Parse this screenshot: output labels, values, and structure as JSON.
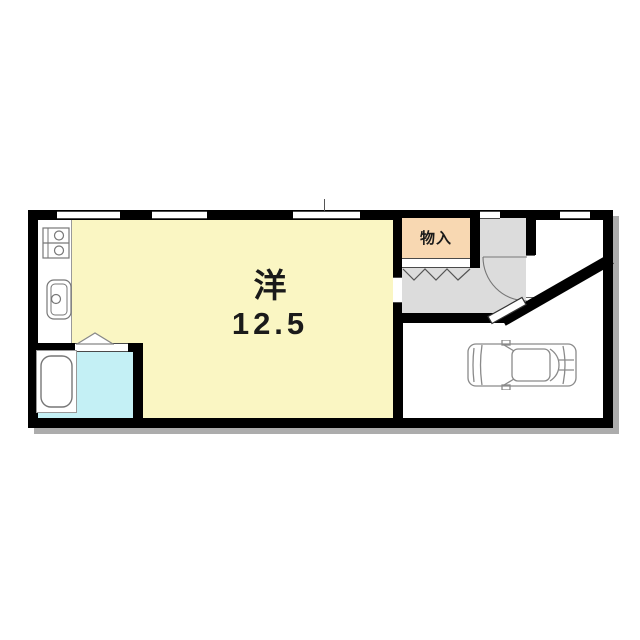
{
  "plan": {
    "type": "japanese-apartment-floor-plan",
    "main_room": {
      "name": "洋",
      "size": "12.5"
    },
    "storage": {
      "label": "物入"
    },
    "colors": {
      "wall": "#000000",
      "shadow": "#acacac",
      "main_room_fill": "#faf6c3",
      "storage_fill": "#f8d8b2",
      "bathroom_fill": "#c4f0f5",
      "entry_hall_fill": "#dcdcdc",
      "parking_fill": "#ffffff",
      "counter_fill": "#ffffff",
      "outline_gray": "#777777",
      "text": "#1a1a1a"
    },
    "icons": [
      "stove-icon",
      "sink-icon",
      "bathtub-icon",
      "bath-folding-door-icon",
      "zigzag-closet-door-icon",
      "door-swing-arc-icon",
      "front-door-leaf-icon",
      "car-icon",
      "window-opening"
    ]
  }
}
